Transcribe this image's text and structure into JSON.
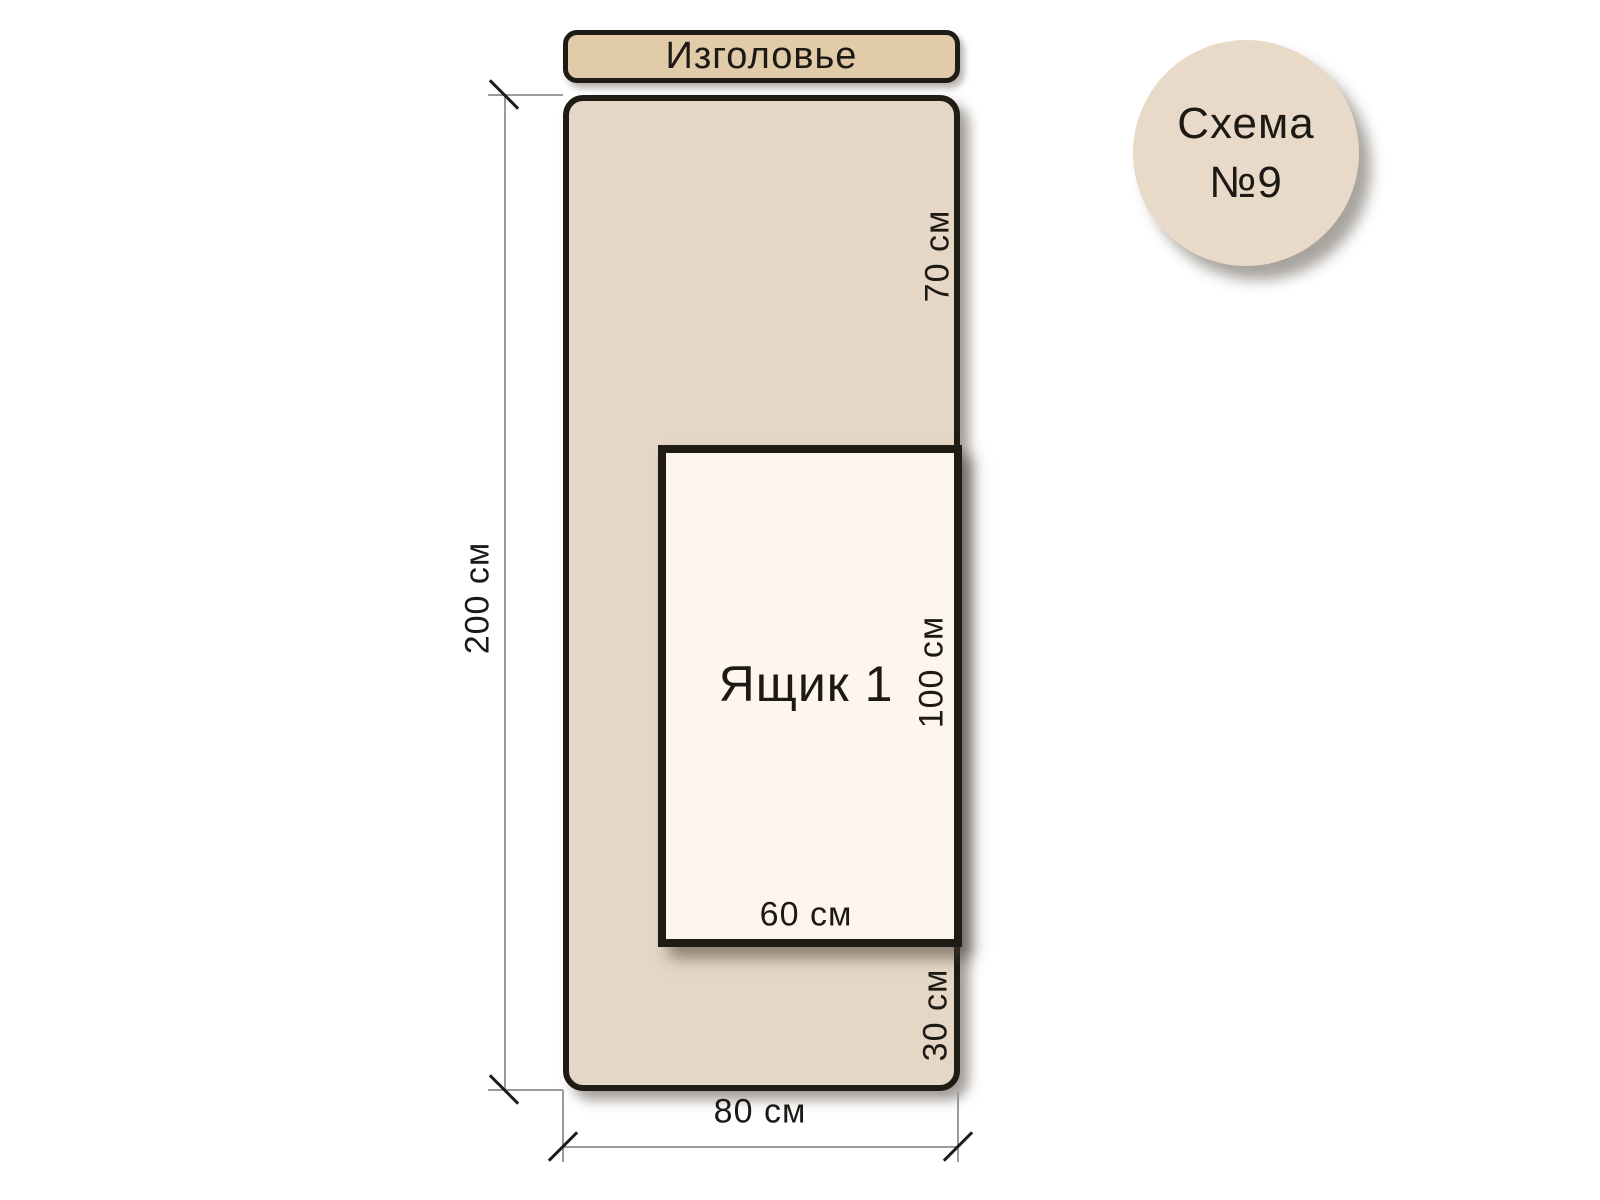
{
  "badge": {
    "line1": "Схема",
    "line2": "№9"
  },
  "headboard": {
    "label": "Изголовье"
  },
  "bed": {
    "height_label": "200 см",
    "width_label": "80 см",
    "top_offset_label": "70 см",
    "bottom_offset_label": "30 см"
  },
  "drawer": {
    "label": "Ящик 1",
    "height_label": "100 см",
    "width_label": "60 см"
  },
  "colors": {
    "headboard_fill": "#e2cba8",
    "bed_fill": "#e5d6c5",
    "drawer_fill": "#fdf5ee",
    "badge_fill": "#e8d9c8",
    "outline": "#1f1b15",
    "text": "#1d1a16",
    "dim_line": "#9a9a9a"
  }
}
